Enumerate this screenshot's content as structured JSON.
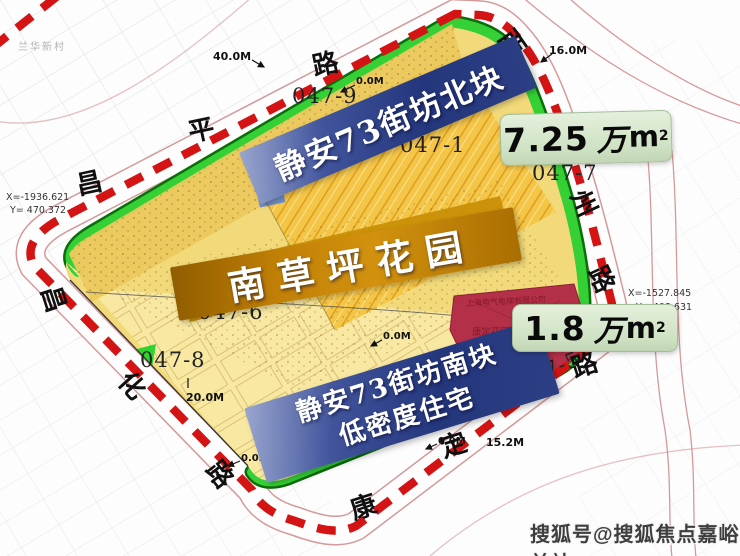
{
  "banners": {
    "north": "静安73街坊北块",
    "center": "南草坪花园",
    "south1": "静安73街坊南块",
    "south2": "低密度住宅"
  },
  "area_labels": {
    "north": {
      "value": "7.25",
      "wan": "万",
      "unit": "m",
      "sup": "2"
    },
    "south": {
      "value": "1.8",
      "wan": "万",
      "unit": "m",
      "sup": "2"
    }
  },
  "parcel_codes": {
    "p047_9": "047-9",
    "p047_1": "047-1",
    "p047_7": "047-7",
    "p047_6": "047-6",
    "p047_8": "047-8",
    "p047_5": "047-5"
  },
  "roads": {
    "north": {
      "c1": "昌",
      "c2": "平",
      "c3": "路"
    },
    "east": {
      "c1": "西",
      "c2": "州",
      "c3": "路"
    },
    "south": {
      "c1": "康",
      "c2": "定",
      "c3": "路"
    },
    "west": {
      "c1": "昌",
      "c2": "化",
      "c3": "路"
    }
  },
  "measurements": {
    "m40": "40.0M",
    "m16": "16.0M",
    "m20": "20.0M",
    "m15": "15.2M",
    "zero": "0.0M"
  },
  "coordinates": {
    "west": {
      "x": "X=-1936.621",
      "y": "Y= 470.372"
    },
    "east": {
      "x": "X=-1527.845",
      "y": "Y= 408.631"
    }
  },
  "red_parcel": {
    "company": "上海电气电梯有限公司",
    "name": "康定花园"
  },
  "background": {
    "neighborhood": "兰华新村"
  },
  "watermark": "搜狐号@搜狐焦点嘉峪关站",
  "colors": {
    "boundary_red": "#d41414",
    "greenbelt": "#35d035",
    "site_yellow": "#f2da7a",
    "strip_yellow": "#f5c646",
    "khaki": "#ecc95e",
    "gold_block": "#c98f06",
    "red_parcel": "#b43048",
    "banner_blue": "#24367c",
    "banner_orange": "#c8830a",
    "area_box_bg": "#cfe2c4"
  }
}
